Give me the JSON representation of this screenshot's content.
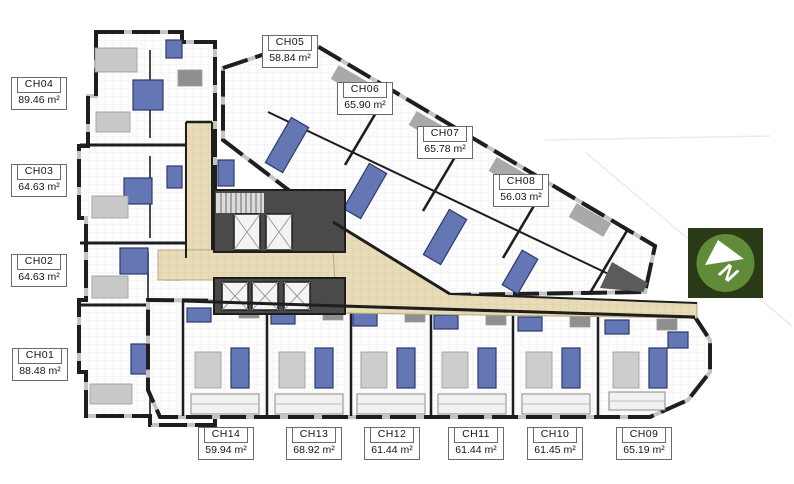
{
  "units": [
    {
      "id": "CH01",
      "area": "88.48 m²"
    },
    {
      "id": "CH02",
      "area": "64.63 m²"
    },
    {
      "id": "CH03",
      "area": "64.63 m²"
    },
    {
      "id": "CH04",
      "area": "89.46 m²"
    },
    {
      "id": "CH05",
      "area": "58.84 m²"
    },
    {
      "id": "CH06",
      "area": "65.90 m²"
    },
    {
      "id": "CH07",
      "area": "65.78 m²"
    },
    {
      "id": "CH08",
      "area": "56.03 m²"
    },
    {
      "id": "CH09",
      "area": "65.19 m²"
    },
    {
      "id": "CH10",
      "area": "61.45 m²"
    },
    {
      "id": "CH11",
      "area": "61.44 m²"
    },
    {
      "id": "CH12",
      "area": "61.44 m²"
    },
    {
      "id": "CH13",
      "area": "68.92 m²"
    },
    {
      "id": "CH14",
      "area": "59.94 m²"
    }
  ],
  "compass": {
    "label": "N"
  },
  "colors": {
    "wall": "#1e1e1e",
    "room_tile": "#fcfcfc",
    "corridor_beige": "#e8dcb8",
    "bathroom_blue": "#6476b4",
    "bathroom_blue_dark": "#2c3a6e",
    "furniture_gray": "#c9c9c9",
    "core_gray": "#4a4a4a",
    "compass_square": "#2b3a16",
    "compass_circle": "#608c3a",
    "label_border": "#6b6b6b"
  }
}
